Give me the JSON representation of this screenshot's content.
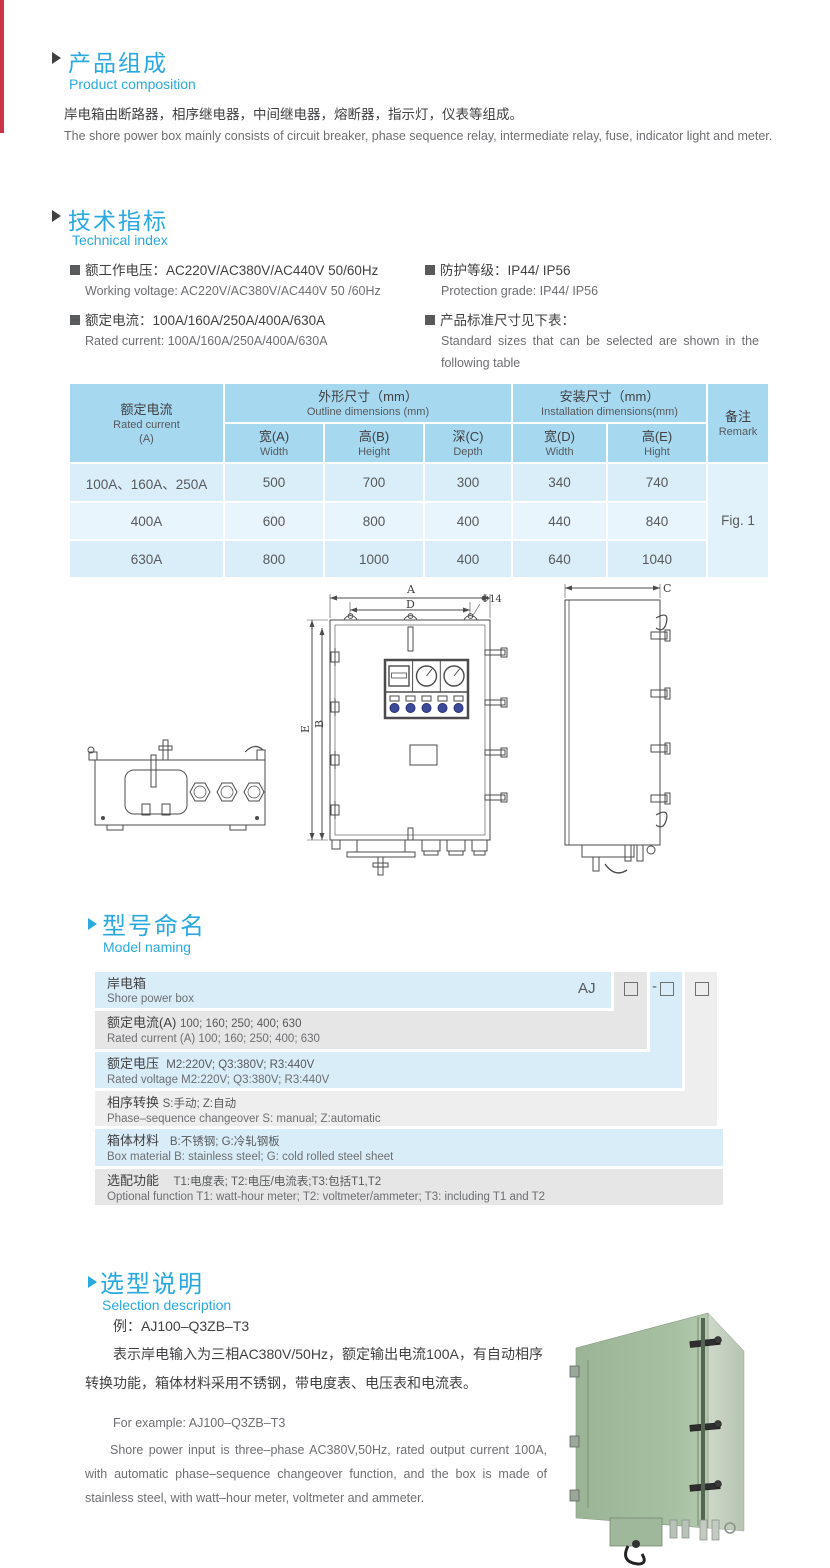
{
  "page": {
    "accent_blue": "#29a9e0",
    "stripe_red": "#cc3347",
    "table_header_blue": "#a6d8f0",
    "table_row_blue": "#d9eef9",
    "stair_blue": "#d9edf8",
    "stair_gray": "#e6e6e6"
  },
  "composition": {
    "title_zh": "产品组成",
    "title_en": "Product  composition",
    "body_zh": "岸电箱由断路器，相序继电器，中间继电器，熔断器，指示灯，仪表等组成。",
    "body_en": "The shore power box mainly consists of circuit breaker, phase sequence relay, intermediate relay, fuse, indicator light and meter."
  },
  "technical": {
    "title_zh": "技术指标",
    "title_en": "Technical index",
    "items": [
      {
        "zh": "额工作电压：AC220V/AC380V/AC440V  50/60Hz",
        "en": "Working voltage: AC220V/AC380V/AC440V 50 /60Hz"
      },
      {
        "zh": "额定电流：100A/160A/250A/400A/630A",
        "en": "Rated current: 100A/160A/250A/400A/630A"
      },
      {
        "zh": "防护等级：IP44/ IP56",
        "en": "Protection grade: IP44/ IP56"
      },
      {
        "zh": "产品标准尺寸见下表：",
        "en": "Standard sizes that can be selected are shown in the following table"
      }
    ]
  },
  "size_table": {
    "col1": {
      "zh": "额定电流",
      "en": "Rated current",
      "unit": "(A)"
    },
    "group1": {
      "zh": "外形尺寸（mm）",
      "en": "Outline dimensions (mm)"
    },
    "group2": {
      "zh": "安装尺寸（mm）",
      "en": "Installation dimensions(mm)"
    },
    "remark": {
      "zh": "备注",
      "en": "Remark"
    },
    "sub": [
      {
        "zh": "宽(A)",
        "en": "Width"
      },
      {
        "zh": "高(B)",
        "en": "Height"
      },
      {
        "zh": "深(C)",
        "en": "Depth"
      },
      {
        "zh": "宽(D)",
        "en": "Width"
      },
      {
        "zh": "高(E)",
        "en": "Hight"
      }
    ],
    "rows": [
      {
        "current": "100A、160A、250A",
        "values": [
          "500",
          "700",
          "300",
          "340",
          "740"
        ]
      },
      {
        "current": "400A",
        "values": [
          "600",
          "800",
          "400",
          "440",
          "840"
        ]
      },
      {
        "current": "630A",
        "values": [
          "800",
          "1000",
          "400",
          "640",
          "1040"
        ]
      }
    ],
    "remark_value": "Fig. 1"
  },
  "drawing": {
    "labels": {
      "A": "A",
      "B": "B",
      "C": "C",
      "D": "D",
      "E": "E",
      "phi": "Φ14"
    }
  },
  "model_naming": {
    "title_zh": "型号命名",
    "title_en": "Model naming",
    "code": {
      "prefix": "AJ",
      "separator": "-"
    },
    "rows": [
      {
        "zh": "岸电箱",
        "en": "Shore power box"
      },
      {
        "zh_label": "额定电流(A)",
        "zh_desc": "100; 160; 250; 400; 630",
        "en": "Rated current (A) 100; 160; 250; 400; 630"
      },
      {
        "zh_label": "额定电压",
        "zh_desc": "M2:220V;  Q3:380V;  R3:440V",
        "en": "Rated voltage  M2:220V;  Q3:380V;  R3:440V"
      },
      {
        "zh_label": "相序转换",
        "zh_desc": "S:手动; Z:自动",
        "en": "Phase–sequence changeover  S: manual;  Z:automatic"
      },
      {
        "zh_label": "箱体材料",
        "zh_desc": "B:不锈钢;  G:冷轧钢板",
        "en": "Box material   B: stainless steel; G: cold rolled steel sheet"
      },
      {
        "zh_label": "选配功能",
        "zh_desc": "T1:电度表;  T2:电压/电流表;T3:包括T1,T2",
        "en": "Optional function   T1: watt-hour meter; T2: voltmeter/ammeter; T3: including T1 and T2"
      }
    ]
  },
  "selection": {
    "title_zh": "选型说明",
    "title_en": "Selection description",
    "example_zh": "例：AJ100–Q3ZB–T3",
    "para_zh": "表示岸电输入为三相AC380V/50Hz，额定输出电流100A，有自动相序转换功能，箱体材料采用不锈钢，带电度表、电压表和电流表。",
    "example_en": "For example: AJ100–Q3ZB–T3",
    "para_en": "Shore power input is three–phase AC380V,50Hz, rated output current 100A, with automatic phase–sequence changeover function, and the box is made of stainless steel, with watt–hour meter, voltmeter and ammeter."
  }
}
